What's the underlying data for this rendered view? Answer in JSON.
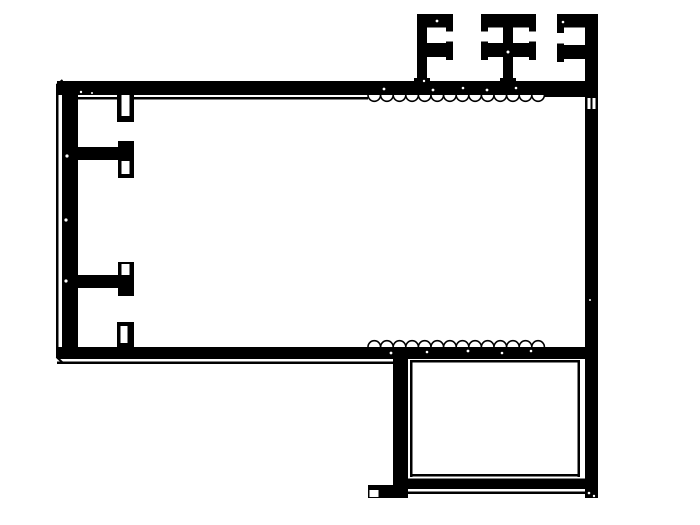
{
  "meta": {
    "title": "aluminum-extrusion-profile-cross-section",
    "drawing_kind": "technical-cad-line-drawing",
    "colors": {
      "ink": "#000000",
      "paper": "#ffffff"
    }
  },
  "canvas": {
    "width": 700,
    "height": 525
  },
  "drawing": {
    "shapes": [
      {
        "type": "circle-row",
        "name": "serration-top-edge",
        "fill": "paper",
        "stroke": "ink",
        "sw": 1.6,
        "cx_start": 374.3,
        "cy": 95,
        "r": 6.3,
        "count": 14,
        "dx": 12.6
      },
      {
        "type": "circle-row",
        "name": "serration-bottom-edge",
        "fill": "paper",
        "stroke": "ink",
        "sw": 1.6,
        "cx_start": 374.3,
        "cy": 347,
        "r": 6.3,
        "count": 14,
        "dx": 12.6
      },
      {
        "type": "rect",
        "name": "top-wall-band",
        "fill": "ink",
        "x": 57,
        "y": 81,
        "w": 528,
        "h": 14
      },
      {
        "type": "rect",
        "name": "bottom-wall-band",
        "fill": "ink",
        "x": 57,
        "y": 347,
        "w": 528,
        "h": 12
      },
      {
        "type": "rect",
        "name": "left-wall",
        "fill": "ink",
        "x": 62,
        "y": 81,
        "w": 16,
        "h": 278
      },
      {
        "type": "rect",
        "name": "left-outer-contour-line",
        "fill": "ink",
        "x": 56,
        "y": 84,
        "w": 2.5,
        "h": 274
      },
      {
        "type": "line",
        "name": "chamfer-top-left",
        "stroke": "ink",
        "sw": 2,
        "x1": 56.5,
        "y1": 85,
        "x2": 62.5,
        "y2": 80
      },
      {
        "type": "line",
        "name": "chamfer-bottom-left",
        "stroke": "ink",
        "sw": 2,
        "x1": 56.5,
        "y1": 357,
        "x2": 62.5,
        "y2": 362.5
      },
      {
        "type": "rect",
        "name": "top-inner-skin-left",
        "fill": "ink",
        "x": 62,
        "y": 97,
        "w": 306,
        "h": 2.5
      },
      {
        "type": "rect",
        "name": "top-inner-skin-right",
        "fill": "ink",
        "x": 544,
        "y": 94.5,
        "w": 41,
        "h": 2.5
      },
      {
        "type": "rect",
        "name": "bottom-outer-contour-line",
        "fill": "ink",
        "x": 57,
        "y": 361.5,
        "w": 336,
        "h": 2.5
      },
      {
        "type": "rect",
        "name": "right-wall",
        "fill": "ink",
        "x": 585,
        "y": 14,
        "w": 13,
        "h": 484
      },
      {
        "type": "rect",
        "name": "fin1-stem",
        "fill": "ink",
        "x": 417,
        "y": 14,
        "w": 10,
        "h": 70
      },
      {
        "type": "rect",
        "name": "fin1-stem-base-flare",
        "fill": "ink",
        "x": 414,
        "y": 78,
        "w": 16,
        "h": 6
      },
      {
        "type": "rect",
        "name": "fin1-top-arm",
        "fill": "ink",
        "x": 417,
        "y": 14,
        "w": 36,
        "h": 13.5
      },
      {
        "type": "rect",
        "name": "fin1-top-arm-cap",
        "fill": "ink",
        "x": 446,
        "y": 14,
        "w": 7,
        "h": 17.5
      },
      {
        "type": "rect",
        "name": "fin1-mid-arm",
        "fill": "ink",
        "x": 417,
        "y": 43,
        "w": 36,
        "h": 14
      },
      {
        "type": "rect",
        "name": "fin1-mid-arm-cap",
        "fill": "ink",
        "x": 446,
        "y": 41.5,
        "w": 7,
        "h": 18.5
      },
      {
        "type": "rect",
        "name": "fin2-stem",
        "fill": "ink",
        "x": 503,
        "y": 14,
        "w": 10,
        "h": 70
      },
      {
        "type": "rect",
        "name": "fin2-stem-base-flare",
        "fill": "ink",
        "x": 500,
        "y": 78,
        "w": 16,
        "h": 6
      },
      {
        "type": "rect",
        "name": "fin2-top-bar",
        "fill": "ink",
        "x": 481,
        "y": 14,
        "w": 55,
        "h": 13.5
      },
      {
        "type": "rect",
        "name": "fin2-top-bar-cap-left",
        "fill": "ink",
        "x": 481,
        "y": 14,
        "w": 7,
        "h": 17.5
      },
      {
        "type": "rect",
        "name": "fin2-top-bar-cap-right",
        "fill": "ink",
        "x": 529,
        "y": 14,
        "w": 7,
        "h": 17.5
      },
      {
        "type": "rect",
        "name": "fin2-mid-bar",
        "fill": "ink",
        "x": 481,
        "y": 43,
        "w": 55,
        "h": 14
      },
      {
        "type": "rect",
        "name": "fin2-mid-bar-cap-left",
        "fill": "ink",
        "x": 481,
        "y": 41.5,
        "w": 7,
        "h": 18.5
      },
      {
        "type": "rect",
        "name": "fin2-mid-bar-cap-right",
        "fill": "ink",
        "x": 529,
        "y": 41.5,
        "w": 7,
        "h": 18.5
      },
      {
        "type": "rect",
        "name": "fin3-top-arm",
        "fill": "ink",
        "x": 557,
        "y": 14,
        "w": 28,
        "h": 13.5
      },
      {
        "type": "rect",
        "name": "fin3-top-arm-cap",
        "fill": "ink",
        "x": 557,
        "y": 14,
        "w": 7,
        "h": 19
      },
      {
        "type": "rect",
        "name": "fin3-mid-arm",
        "fill": "ink",
        "x": 557,
        "y": 45,
        "w": 28,
        "h": 14
      },
      {
        "type": "rect",
        "name": "fin3-mid-arm-cap",
        "fill": "ink",
        "x": 557,
        "y": 43.5,
        "w": 7,
        "h": 18.5
      },
      {
        "type": "rect",
        "name": "screw-boss-top",
        "fill": "ink",
        "x": 117,
        "y": 95,
        "w": 17,
        "h": 27
      },
      {
        "type": "rect",
        "name": "screw-boss-top-slot",
        "fill": "paper",
        "x": 121.5,
        "y": 95,
        "w": 8,
        "h": 21
      },
      {
        "type": "rect",
        "name": "mid-arm-web",
        "fill": "ink",
        "x": 78,
        "y": 147,
        "w": 50,
        "h": 13
      },
      {
        "type": "rect",
        "name": "mid-arm-end-bar",
        "fill": "ink",
        "x": 118,
        "y": 141,
        "w": 16,
        "h": 37
      },
      {
        "type": "rect",
        "name": "mid-arm-end-slot",
        "fill": "paper",
        "x": 121.5,
        "y": 161,
        "w": 8,
        "h": 13
      },
      {
        "type": "rect",
        "name": "low-arm-web",
        "fill": "ink",
        "x": 78,
        "y": 275,
        "w": 50,
        "h": 13
      },
      {
        "type": "rect",
        "name": "low-arm-end-bar",
        "fill": "ink",
        "x": 118,
        "y": 262,
        "w": 16,
        "h": 34
      },
      {
        "type": "rect",
        "name": "low-arm-end-slot",
        "fill": "paper",
        "x": 121.5,
        "y": 264,
        "w": 8,
        "h": 11
      },
      {
        "type": "rect",
        "name": "screw-boss-bottom",
        "fill": "ink",
        "x": 117,
        "y": 322,
        "w": 17,
        "h": 25
      },
      {
        "type": "rect",
        "name": "screw-boss-bottom-slot",
        "fill": "paper",
        "x": 120.5,
        "y": 326,
        "w": 7,
        "h": 17
      },
      {
        "type": "rect",
        "name": "right-wall-notch-a",
        "fill": "paper",
        "x": 587.5,
        "y": 98,
        "w": 3,
        "h": 11
      },
      {
        "type": "rect",
        "name": "right-wall-notch-b",
        "fill": "paper",
        "x": 592.5,
        "y": 98,
        "w": 3,
        "h": 11
      },
      {
        "type": "rect",
        "name": "lowerbox-left-wall",
        "fill": "ink",
        "x": 393,
        "y": 347,
        "w": 15,
        "h": 151
      },
      {
        "type": "rect",
        "name": "lowerbox-left-inner-skin",
        "fill": "ink",
        "x": 410,
        "y": 360,
        "w": 2.5,
        "h": 117
      },
      {
        "type": "rect",
        "name": "lowerbox-top-inner-skin",
        "fill": "ink",
        "x": 410,
        "y": 360,
        "w": 170,
        "h": 2.5
      },
      {
        "type": "rect",
        "name": "lowerbox-right-inner-skin",
        "fill": "ink",
        "x": 577.5,
        "y": 360,
        "w": 2.5,
        "h": 117
      },
      {
        "type": "rect",
        "name": "lowerbox-bottom-inner-skin",
        "fill": "ink",
        "x": 410,
        "y": 474,
        "w": 170,
        "h": 2.5
      },
      {
        "type": "rect",
        "name": "lowerbox-bottom-band",
        "fill": "ink",
        "x": 408,
        "y": 478.5,
        "w": 177,
        "h": 10.5
      },
      {
        "type": "rect",
        "name": "lowerbox-bottom-outer-line",
        "fill": "ink",
        "x": 408,
        "y": 491.5,
        "w": 177,
        "h": 2.5
      },
      {
        "type": "rect",
        "name": "lowerbox-left-foot",
        "fill": "ink",
        "x": 368,
        "y": 485,
        "w": 27,
        "h": 13
      },
      {
        "type": "rect",
        "name": "lowerbox-left-foot-notch",
        "fill": "paper",
        "x": 369.5,
        "y": 490,
        "w": 9,
        "h": 7
      },
      {
        "type": "dot",
        "name": "scan-noise",
        "fill": "paper",
        "x": 67,
        "y": 156,
        "r": 1.6
      },
      {
        "type": "dot",
        "name": "scan-noise",
        "fill": "paper",
        "x": 66,
        "y": 220,
        "r": 1.6
      },
      {
        "type": "dot",
        "name": "scan-noise",
        "fill": "paper",
        "x": 66,
        "y": 281,
        "r": 1.6
      },
      {
        "type": "dot",
        "name": "scan-noise",
        "fill": "paper",
        "x": 81,
        "y": 92,
        "r": 1.2
      },
      {
        "type": "dot",
        "name": "scan-noise",
        "fill": "paper",
        "x": 92,
        "y": 93,
        "r": 1.0
      },
      {
        "type": "dot",
        "name": "scan-noise",
        "fill": "paper",
        "x": 384,
        "y": 89,
        "r": 1.4
      },
      {
        "type": "dot",
        "name": "scan-noise",
        "fill": "paper",
        "x": 433,
        "y": 90,
        "r": 1.4
      },
      {
        "type": "dot",
        "name": "scan-noise",
        "fill": "paper",
        "x": 463,
        "y": 88,
        "r": 1.3
      },
      {
        "type": "dot",
        "name": "scan-noise",
        "fill": "paper",
        "x": 487,
        "y": 90,
        "r": 1.4
      },
      {
        "type": "dot",
        "name": "scan-noise",
        "fill": "paper",
        "x": 516,
        "y": 88,
        "r": 1.3
      },
      {
        "type": "dot",
        "name": "scan-noise",
        "fill": "paper",
        "x": 391,
        "y": 353,
        "r": 1.4
      },
      {
        "type": "dot",
        "name": "scan-noise",
        "fill": "paper",
        "x": 427,
        "y": 352,
        "r": 1.3
      },
      {
        "type": "dot",
        "name": "scan-noise",
        "fill": "paper",
        "x": 468,
        "y": 351,
        "r": 1.4
      },
      {
        "type": "dot",
        "name": "scan-noise",
        "fill": "paper",
        "x": 502,
        "y": 353,
        "r": 1.3
      },
      {
        "type": "dot",
        "name": "scan-noise",
        "fill": "paper",
        "x": 531,
        "y": 351,
        "r": 1.3
      },
      {
        "type": "dot",
        "name": "scan-noise",
        "fill": "paper",
        "x": 437,
        "y": 21,
        "r": 1.4
      },
      {
        "type": "dot",
        "name": "scan-noise",
        "fill": "paper",
        "x": 508,
        "y": 52,
        "r": 1.5
      },
      {
        "type": "dot",
        "name": "scan-noise",
        "fill": "paper",
        "x": 563,
        "y": 22,
        "r": 1.3
      },
      {
        "type": "dot",
        "name": "scan-noise",
        "fill": "paper",
        "x": 589,
        "y": 493,
        "r": 1.3
      },
      {
        "type": "dot",
        "name": "scan-noise",
        "fill": "paper",
        "x": 594,
        "y": 496,
        "r": 1.2
      },
      {
        "type": "dot",
        "name": "scan-noise",
        "fill": "paper",
        "x": 374,
        "y": 492,
        "r": 1.2
      },
      {
        "type": "dot",
        "name": "scan-noise",
        "fill": "paper",
        "x": 424,
        "y": 81,
        "r": 1.2
      },
      {
        "type": "dot",
        "name": "scan-noise",
        "fill": "paper",
        "x": 590,
        "y": 300,
        "r": 1.0
      }
    ]
  }
}
